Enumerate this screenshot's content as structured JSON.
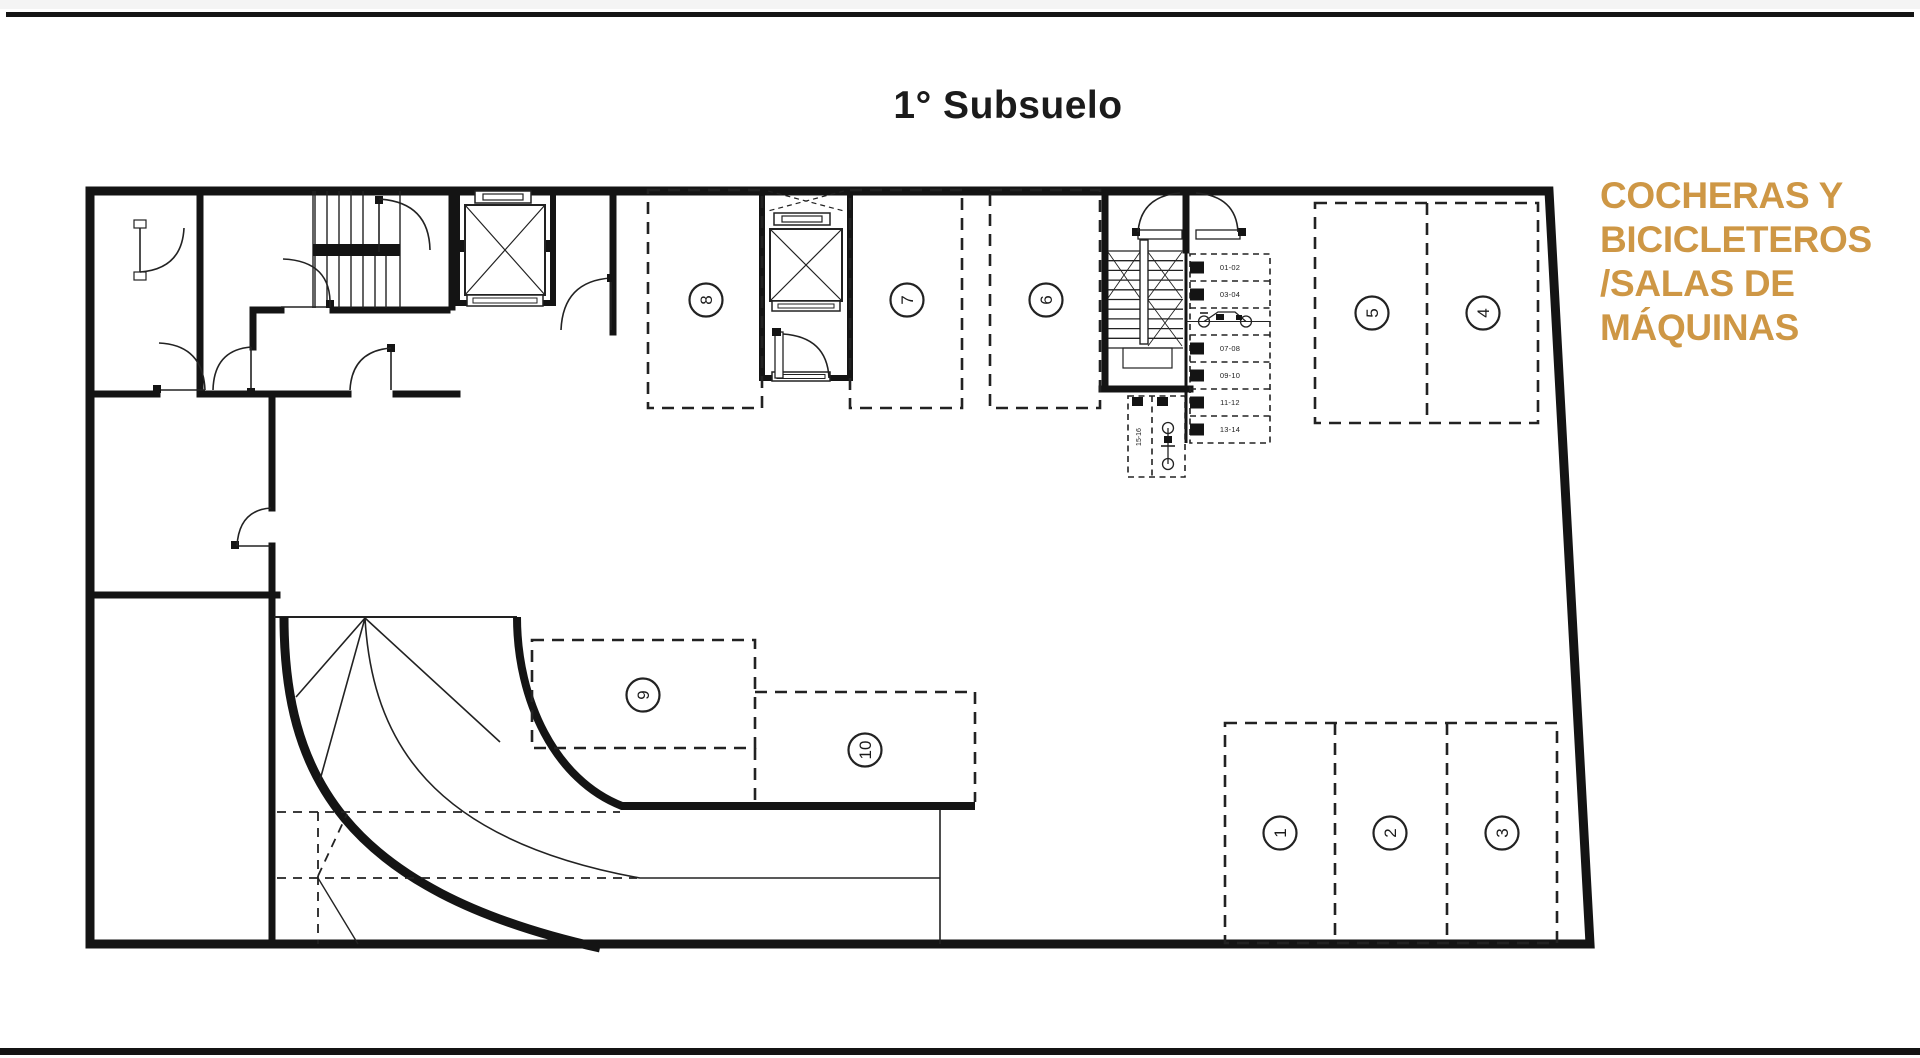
{
  "page": {
    "title": "1° Subsuelo"
  },
  "legend": {
    "lines": [
      "COCHERAS Y",
      "BICICLETEROS",
      "/SALAS DE",
      "MÁQUINAS"
    ],
    "color": "#CE9745"
  },
  "plan": {
    "wall_color": "#141414",
    "spots": [
      {
        "label": "1"
      },
      {
        "label": "2"
      },
      {
        "label": "3"
      },
      {
        "label": "4"
      },
      {
        "label": "5"
      },
      {
        "label": "6"
      },
      {
        "label": "7"
      },
      {
        "label": "8"
      },
      {
        "label": "9"
      },
      {
        "label": "10"
      }
    ],
    "bike_rack": {
      "rows": [
        {
          "label": "01-02"
        },
        {
          "label": "03-04"
        },
        {
          "label": "",
          "icon": "bicycle"
        },
        {
          "label": "07-08"
        },
        {
          "label": "09-10"
        },
        {
          "label": "11-12"
        },
        {
          "label": "13-14"
        }
      ],
      "vertical_label": "15-16"
    }
  }
}
